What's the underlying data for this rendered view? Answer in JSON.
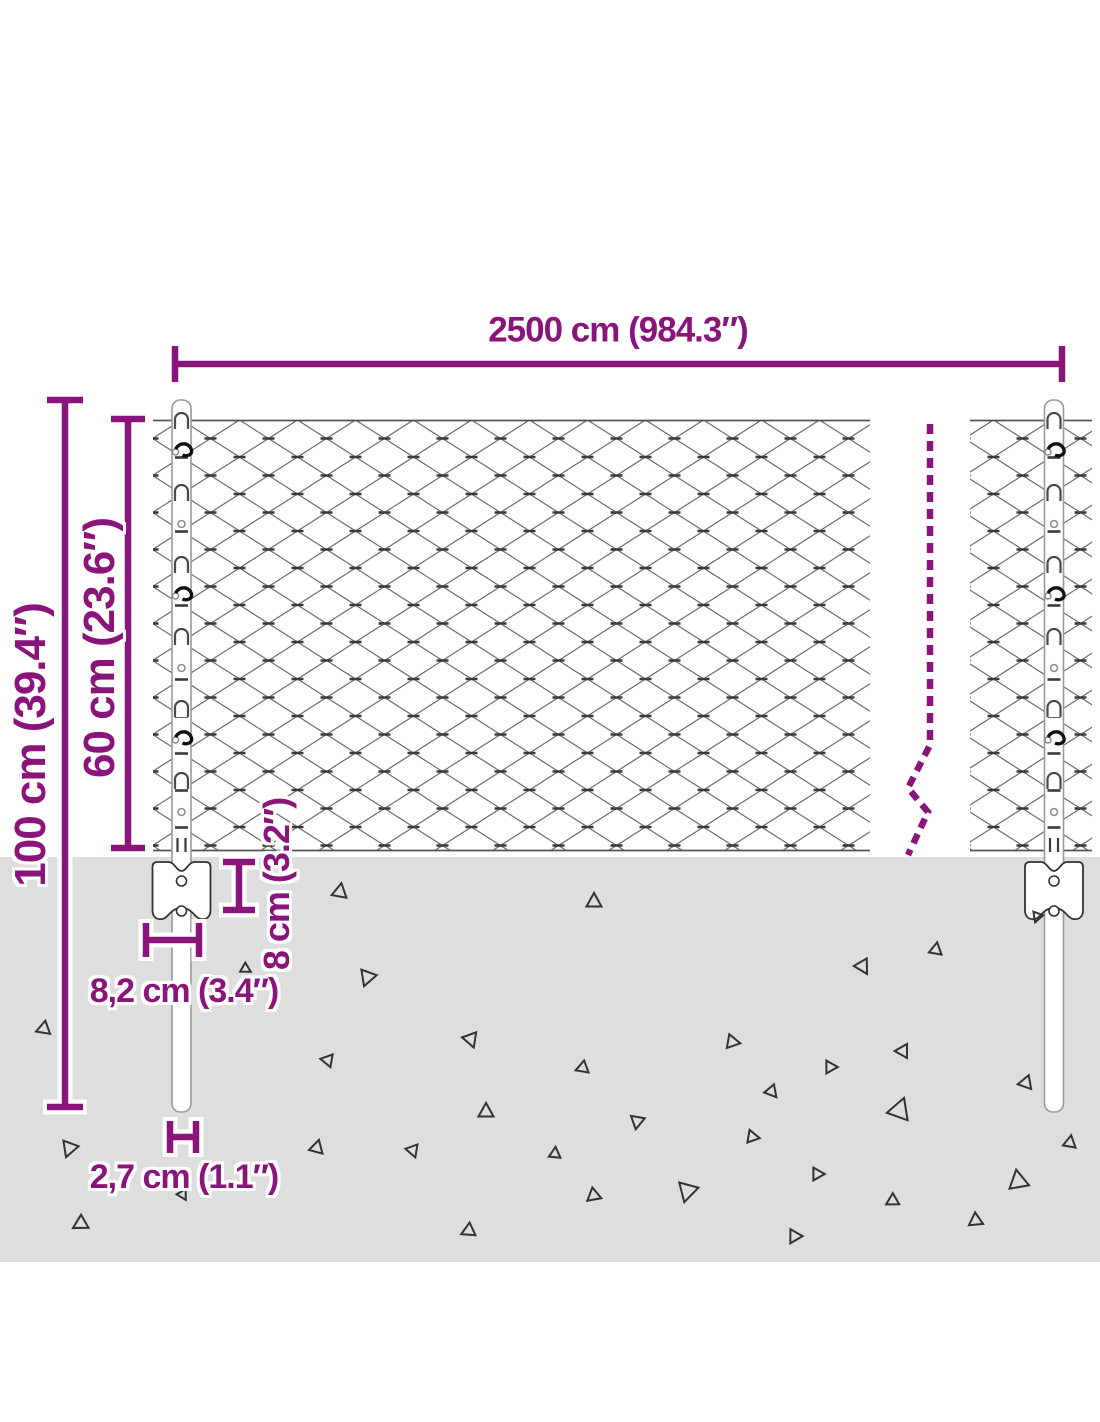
{
  "colors": {
    "accent": "#8a157a",
    "ground": "#dedede",
    "wire": "#6f6f6f",
    "wire_dark": "#3a3a3a",
    "edge_wire": "#555555",
    "post_outline": "#9a9a9a",
    "bracket_outline": "#333333",
    "debris": "#333333",
    "tie": "#111111"
  },
  "dimensions": {
    "total_width": {
      "label": "2500 cm (984.3″)"
    },
    "total_height": {
      "label": "100 cm (39.4″)"
    },
    "mesh_height": {
      "label": "60 cm (23.6″)"
    },
    "anchor_depth": {
      "label": "8 cm (3.2″)"
    },
    "anchor_width": {
      "label": "8,2 cm (3.4″)"
    },
    "post_width": {
      "label": "2,7 cm (1.1″)"
    }
  },
  "dim_lines": [
    {
      "id": "total_width",
      "orient": "h",
      "at": 364,
      "from": 175,
      "to": 1062,
      "cap": 18
    },
    {
      "id": "total_height",
      "orient": "v",
      "at": 65,
      "from": 400,
      "to": 1107,
      "cap": 18
    },
    {
      "id": "mesh_height",
      "orient": "v",
      "at": 128,
      "from": 419,
      "to": 848,
      "cap": 17
    },
    {
      "id": "anchor_depth",
      "orient": "v",
      "at": 239,
      "from": 862,
      "to": 910,
      "cap": 16
    },
    {
      "id": "anchor_width",
      "orient": "h",
      "at": 940,
      "from": 146,
      "to": 199,
      "cap": 17
    },
    {
      "id": "post_width",
      "orient": "h",
      "at": 1137,
      "from": 170,
      "to": 196,
      "cap": 16
    }
  ],
  "fence": {
    "ground_top": 857,
    "ground_bottom": 1262,
    "mesh_top": 420,
    "mesh_bottom": 850,
    "panels": [
      [
        153,
        870
      ],
      [
        970,
        1092
      ]
    ],
    "cell": {
      "w": 58,
      "h": 37,
      "offset_x": 7.5,
      "offset_y": 13
    },
    "post_top": 400,
    "post_bottom": 1112,
    "post_width": 19,
    "posts": [
      181.5,
      1054
    ],
    "hooks": [
      413,
      485,
      557,
      629,
      701,
      773
    ],
    "mids": [
      [
        449,
        "tie"
      ],
      [
        521,
        "circle"
      ],
      [
        593,
        "tie"
      ],
      [
        665,
        "circle"
      ],
      [
        737,
        "tie"
      ],
      [
        809,
        "circle"
      ]
    ],
    "wire_end_y": 838,
    "bracket": {
      "top": 862,
      "bottom": 920,
      "half_width": 29,
      "hole_r": 5,
      "hole_y1": 881,
      "hole_y2": 911
    },
    "break_line": [
      [
        930,
        424
      ],
      [
        930,
        745
      ],
      [
        908,
        788
      ],
      [
        928,
        812
      ],
      [
        908,
        855
      ]
    ]
  },
  "ground_debris": [
    [
      340,
      891,
      13,
      10
    ],
    [
      594,
      901,
      13,
      0
    ],
    [
      246,
      969,
      9,
      120
    ],
    [
      367,
      978,
      14,
      200
    ],
    [
      863,
      967,
      13,
      150
    ],
    [
      936,
      949,
      11,
      10
    ],
    [
      1037,
      917,
      9,
      200
    ],
    [
      43,
      1029,
      12,
      250
    ],
    [
      471,
      1040,
      13,
      160
    ],
    [
      733,
      1042,
      12,
      100
    ],
    [
      902,
      1051,
      12,
      270
    ],
    [
      582,
      1068,
      11,
      250
    ],
    [
      831,
      1067,
      11,
      90
    ],
    [
      1025,
      1083,
      12,
      260
    ],
    [
      327,
      1060,
      11,
      280
    ],
    [
      900,
      1109,
      19,
      20
    ],
    [
      772,
      1092,
      11,
      140
    ],
    [
      486,
      1111,
      13,
      0
    ],
    [
      637,
      1122,
      12,
      190
    ],
    [
      69,
      1149,
      14,
      200
    ],
    [
      317,
      1147,
      12,
      15
    ],
    [
      413,
      1151,
      11,
      160
    ],
    [
      555,
      1153,
      10,
      5
    ],
    [
      753,
      1137,
      11,
      100
    ],
    [
      1070,
      1142,
      11,
      10
    ],
    [
      593,
      1196,
      12,
      230
    ],
    [
      687,
      1192,
      17,
      195
    ],
    [
      818,
      1174,
      11,
      90
    ],
    [
      892,
      1201,
      11,
      240
    ],
    [
      1018,
      1180,
      17,
      350
    ],
    [
      183,
      1195,
      9,
      150
    ],
    [
      975,
      1221,
      12,
      235
    ],
    [
      794,
      1237,
      12,
      210
    ],
    [
      80,
      1224,
      13,
      240
    ],
    [
      468,
      1231,
      12,
      245
    ]
  ]
}
